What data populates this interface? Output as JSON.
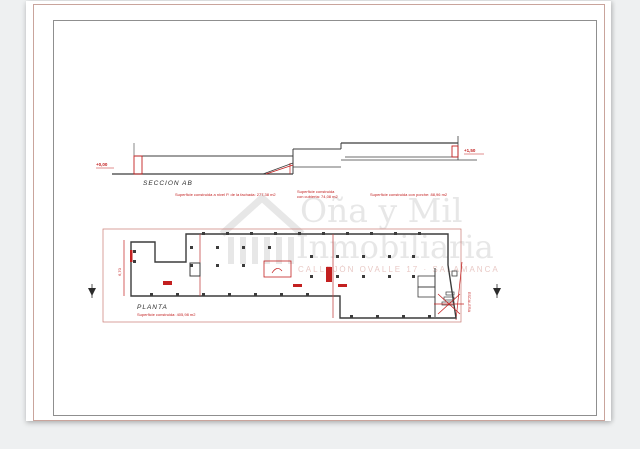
{
  "colors": {
    "canvas": "#eef0f1",
    "sheet": "#ffffff",
    "outer_frame": "#c9a49c",
    "inner_frame": "#8f8f8f",
    "ink": "#3c3c3c",
    "red": "#c32020",
    "watermark_gray": "#e3e3e3",
    "watermark_pink": "#dcaaa4"
  },
  "watermark": {
    "brand_top": "Oña y Mil",
    "brand_bottom": "Inmobiliaria",
    "address": "CALLEJÓN OVALLE 17 · SALAMANCA",
    "logo": "house-icon"
  },
  "section": {
    "title": "SECCION AB",
    "left_level": "+0,00",
    "right_level": "+1,50",
    "note_left": "Superficie construida a nivel P. de la fachada: 277,38 m2",
    "note_mid_line1": "Superficie construida",
    "note_mid_line2": "con cubierta: 74,08 m2",
    "note_right": "Superficie construida con porche: 88,96 m2"
  },
  "plan": {
    "title": "PLANTA",
    "area_note": "Superficie construida: 405,98 m2",
    "left_dim": "6,70",
    "stair_label": "ESCALERA"
  }
}
